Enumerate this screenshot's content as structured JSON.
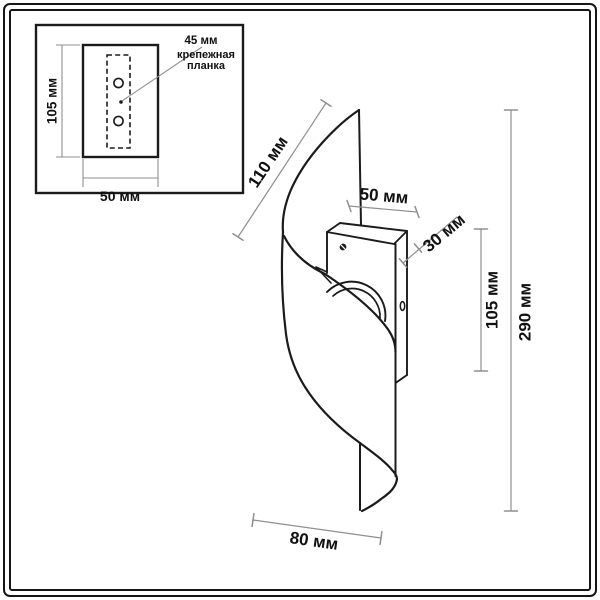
{
  "inset": {
    "plate_height_label": "105 мм",
    "plate_width_label": "50 мм",
    "callout_size": "45 мм",
    "callout_caption_line1": "крепежная",
    "callout_caption_line2": "планка"
  },
  "main": {
    "dim_diagonal_top": "110 мм",
    "dim_bracket_width": "50 мм",
    "dim_bracket_depth": "30 мм",
    "dim_bracket_height": "105 мм",
    "dim_total_height": "290 мм",
    "dim_bottom_width": "80 мм"
  },
  "colors": {
    "line": "#1b1b1b",
    "dim_line": "#8f8f8f",
    "text": "#111111",
    "background": "#ffffff"
  }
}
